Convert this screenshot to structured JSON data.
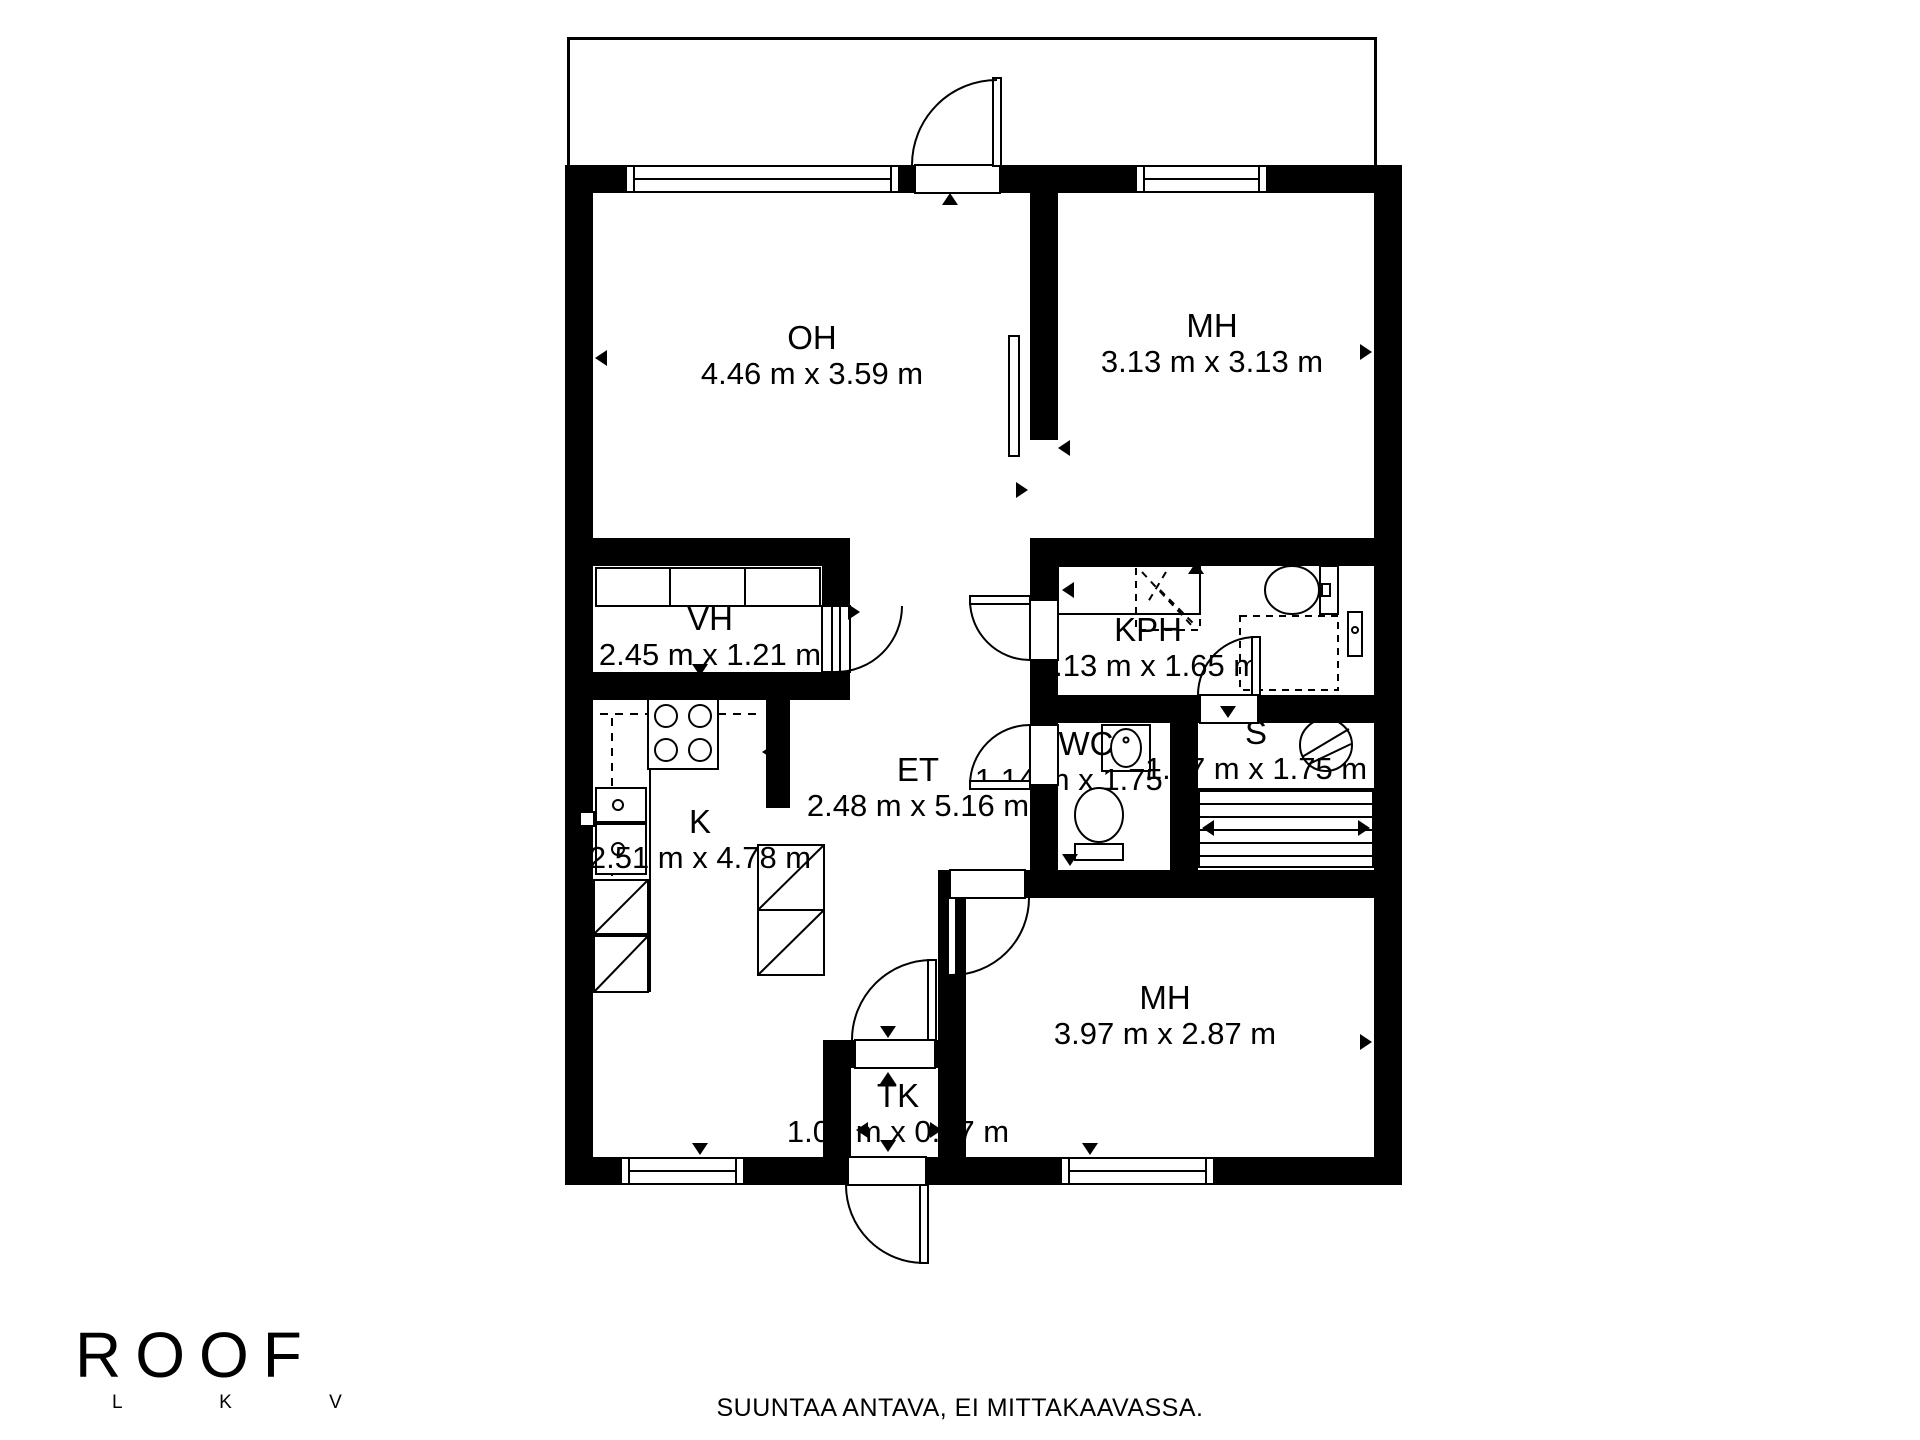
{
  "plan": {
    "rooms": [
      {
        "id": "oh",
        "name": "OH",
        "dims": "4.46 m x 3.59 m"
      },
      {
        "id": "mh_top",
        "name": "MH",
        "dims": "3.13 m x 3.13 m"
      },
      {
        "id": "vh",
        "name": "VH",
        "dims": "2.45 m x 1.21 m"
      },
      {
        "id": "kph",
        "name": "KPH",
        "dims": "3.13 m x 1.65 m"
      },
      {
        "id": "wc",
        "name": "WC",
        "dims": "1.14 m x 1.75 m"
      },
      {
        "id": "s",
        "name": "S",
        "dims": "1.87 m x 1.75 m"
      },
      {
        "id": "et",
        "name": "ET",
        "dims": "2.48 m x 5.16 m"
      },
      {
        "id": "k",
        "name": "K",
        "dims": "2.51 m x 4.78 m"
      },
      {
        "id": "mh_bottom",
        "name": "MH",
        "dims": "3.97 m x 2.87 m"
      },
      {
        "id": "tk",
        "name": "TK",
        "dims": "1.08 m x 0.87 m"
      }
    ],
    "icons": [
      "stove-icon",
      "kitchen-sink-icon",
      "fridge-icon",
      "wardrobe-icon",
      "shower-icon",
      "washing-machine-icon",
      "toilet-icon",
      "hand-basin-icon",
      "sauna-stove-icon",
      "sauna-bench-icon",
      "sliding-door-icon",
      "door-swing-icon",
      "window-icon",
      "direction-arrow-icon"
    ],
    "colors": {
      "wall": "#000000",
      "floor": "#ffffff"
    }
  },
  "footer": {
    "logo_text": "ROOF",
    "logo_sub": "L K V",
    "caption": "SUUNTAA ANTAVA, EI MITTAKAAVASSA."
  }
}
